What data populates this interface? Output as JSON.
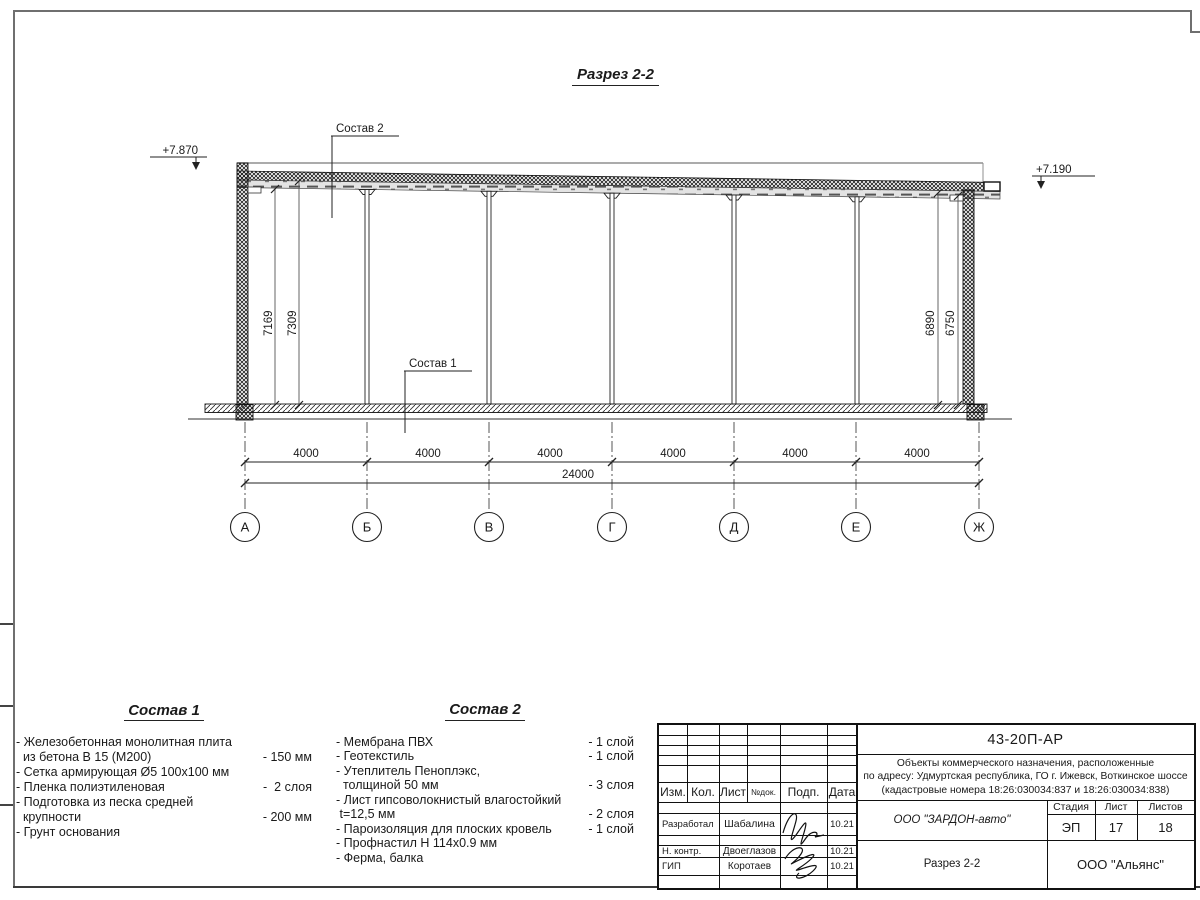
{
  "drawing": {
    "title": "Разрез 2-2",
    "elevations": {
      "left": "+7.870",
      "right": "+7.190"
    },
    "callouts": {
      "sostav2": "Состав 2",
      "sostav1": "Состав 1"
    },
    "vertical_dims": {
      "left_inner": "7169",
      "left_outer": "7309",
      "right_inner": "6890",
      "right_outer": "6750"
    },
    "bay_dims": [
      "4000",
      "4000",
      "4000",
      "4000",
      "4000",
      "4000"
    ],
    "total_dim": "24000",
    "axes": [
      "А",
      "Б",
      "В",
      "Г",
      "Д",
      "Е",
      "Ж"
    ]
  },
  "sostav1": {
    "title": "Состав 1",
    "items": [
      {
        "name": "- Железобетонная  монолитная плита\n  из бетона В 15 (М200)",
        "value": "- 150 мм"
      },
      {
        "name": "- Сетка армирующая Ø5 100х100 мм",
        "value": ""
      },
      {
        "name": "- Пленка полиэтиленовая",
        "value": "-  2 слоя"
      },
      {
        "name": "- Подготовка из песка средней\n  крупности",
        "value": "- 200 мм"
      },
      {
        "name": "- Грунт основания",
        "value": ""
      }
    ]
  },
  "sostav2": {
    "title": "Состав 2",
    "items": [
      {
        "name": "- Мембрана ПВХ",
        "value": "- 1 слой"
      },
      {
        "name": "- Геотекстиль",
        "value": "- 1 слой"
      },
      {
        "name": "- Утеплитель Пеноплэкс,\n  толщиной 50 мм",
        "value": "- 3 слоя"
      },
      {
        "name": "- Лист гипсоволокнистый влагостойкий\n t=12,5 мм",
        "value": "- 2 слоя"
      },
      {
        "name": "- Пароизоляция для плоских кровель",
        "value": "- 1 слой"
      },
      {
        "name": "- Профнастил Н 114х0.9 мм",
        "value": ""
      },
      {
        "name": "- Ферма, балка",
        "value": ""
      }
    ]
  },
  "titleblock": {
    "doc_code": "43-20П-АР",
    "project": "Объекты коммерческого назначения, расположенные\nпо адресу: Удмуртская республика, ГО г. Ижевск, Воткинское шоссе\n(кадастровые номера 18:26:030034:837 и 18:26:030034:838)",
    "headers": {
      "izm": "Изм.",
      "kol": "Кол.",
      "list": "Лист",
      "ndok": "№док.",
      "podp": "Подп.",
      "data": "Дата"
    },
    "rows": [
      {
        "role": "Разработал",
        "name": "Шабалина",
        "date": "10.21"
      },
      {
        "role": "Н. контр.",
        "name": "Двоеглазов",
        "date": "10.21"
      },
      {
        "role": "ГИП",
        "name": "Коротаев",
        "date": "10.21"
      }
    ],
    "company": "ООО \"ЗАРДОН-авто\"",
    "stage_label": "Стадия",
    "sheet_label": "Лист",
    "sheets_label": "Листов",
    "stage": "ЭП",
    "sheet": "17",
    "sheets": "18",
    "drawing_name": "Разрез 2-2",
    "contractor": "ООО \"Альянс\""
  }
}
